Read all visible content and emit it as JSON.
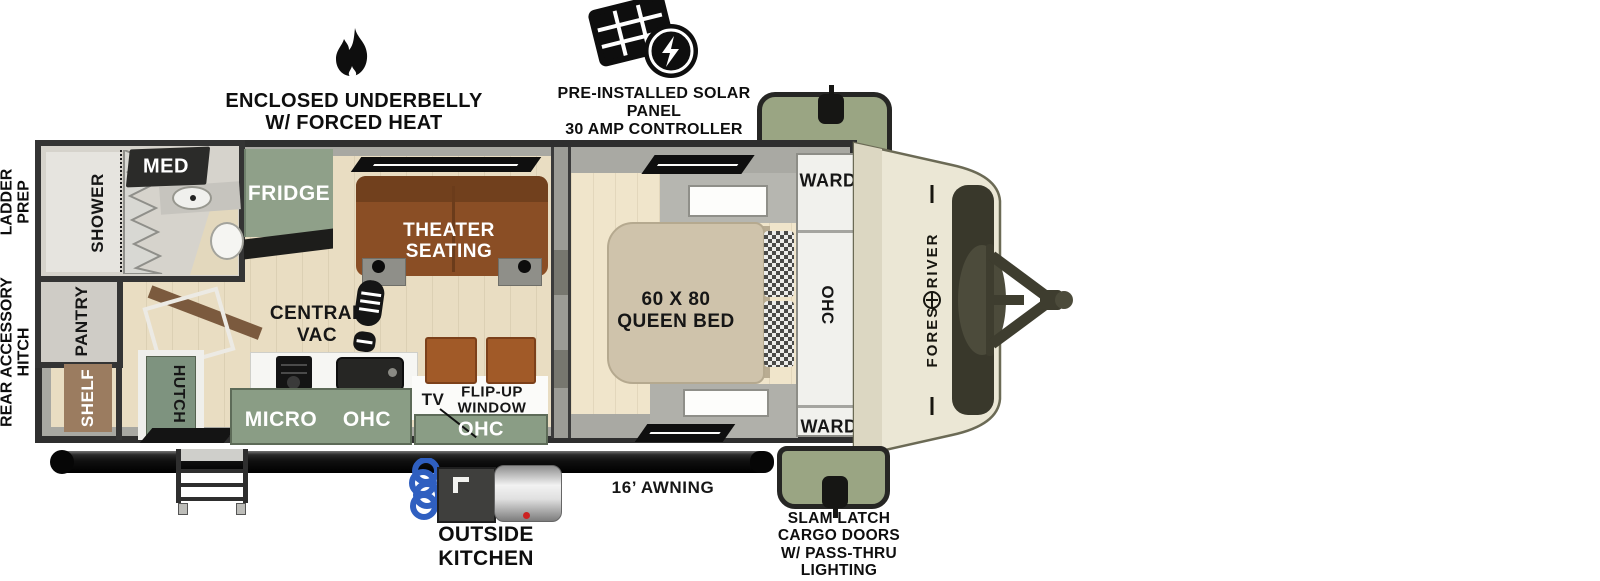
{
  "callouts": {
    "underbelly": {
      "line1": "ENCLOSED UNDERBELLY",
      "line2": "W/ FORCED HEAT"
    },
    "solar": {
      "line1": "PRE-INSTALLED SOLAR PANEL",
      "line2": "30 AMP CONTROLLER",
      "line3": "& INVERTER PREP"
    },
    "ladder_prep": {
      "line1": "LADDER",
      "line2": "PREP"
    },
    "rear_accessory_hitch": {
      "line1": "REAR ACCESSORY",
      "line2": "HITCH"
    },
    "awning": "16’ AWNING",
    "outside_kitchen": {
      "line1": "OUTSIDE",
      "line2": "KITCHEN"
    },
    "cargo_doors": {
      "line1": "SLAM LATCH",
      "line2": "CARGO DOORS",
      "line3": "W/ PASS-THRU",
      "line4": "LIGHTING"
    }
  },
  "rooms": {
    "shower": "SHOWER",
    "med_cabinet": "MED",
    "pantry": "PANTRY",
    "shelf": "SHELF",
    "hutch": "HUTCH",
    "fridge": "FRIDGE",
    "theater_seating": {
      "line1": "THEATER",
      "line2": "SEATING"
    },
    "central_vac": {
      "line1": "CENTRAL",
      "line2": "VAC"
    },
    "microwave": "MICRO",
    "ohc_kitchen": "OHC",
    "tv": "TV",
    "flip_up_window": {
      "line1": "FLIP-UP",
      "line2": "WINDOW"
    },
    "ohc_kitchen_right": "OHC",
    "queen_bed": {
      "line1": "60 X 80",
      "line2": "QUEEN BED"
    },
    "ward_front": "WARD",
    "ohc_bedroom": "OHC",
    "ward_rear": "WARD"
  },
  "brand": "FOREST RIVER",
  "colors": {
    "cargo_door_green": "#9aa583",
    "cabinet_green": "#8a9d85",
    "couch_brown": "#8a4e25",
    "bed_tan": "#cfc3ab",
    "floor_wood": "#e9ddc2",
    "front_cap_cream": "#ebe7d5",
    "outline": "#2f2f2f"
  }
}
